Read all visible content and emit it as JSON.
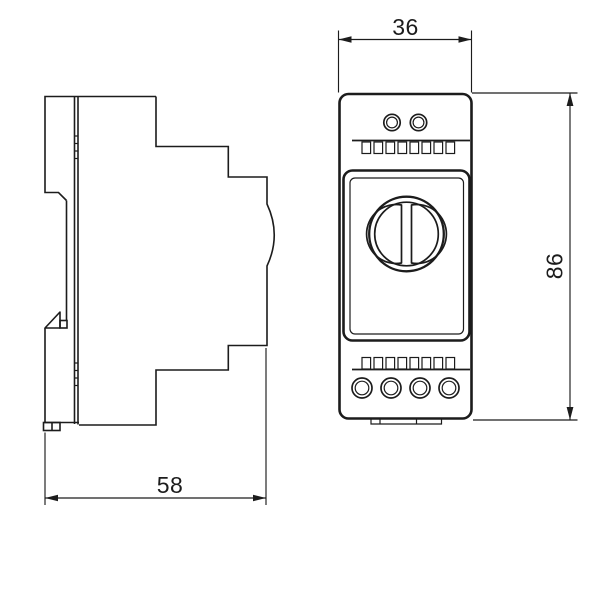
{
  "meta": {
    "background_color": "#ffffff",
    "line_color": "#1c1c1c",
    "kind": "technical dimension drawing of DIN-rail enclosure"
  },
  "drawing": {
    "views": [
      {
        "name": "side-view",
        "description": "left side profile with DIN-rail clip"
      },
      {
        "name": "front-view",
        "description": "front face with rotary dial, vent slots and terminal screws"
      }
    ],
    "dimensions": [
      {
        "name": "front-width",
        "label": "36"
      },
      {
        "name": "height",
        "label": "86"
      },
      {
        "name": "depth",
        "label": "58"
      }
    ]
  }
}
